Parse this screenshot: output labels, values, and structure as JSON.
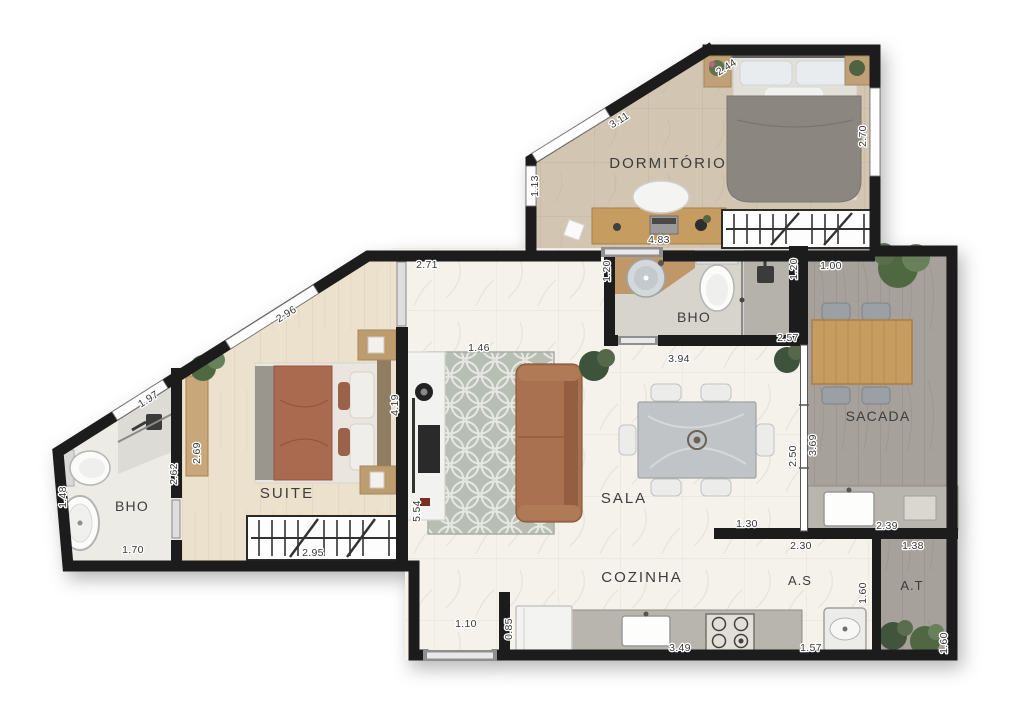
{
  "plan": {
    "rooms": {
      "dormitorio": "DORMITÓRIO",
      "bathroom_top": "BHO",
      "balcony": "SACADA",
      "suite": "SUITE",
      "bathroom_suite": "BHO",
      "living": "SALA",
      "kitchen": "COZINHA",
      "service": "A.S",
      "technical": "A.T"
    },
    "dims": {
      "dorm_diag_upper": "2.44",
      "dorm_diag": "3.11",
      "dorm_left": "1.13",
      "dorm_right": "2.70",
      "dorm_desk": "4.83",
      "hall_width": "2.71",
      "hall_opening": "1.46",
      "bath_top_left": "1.20",
      "bath_top_right": "1.20",
      "bath_top_bottom": "2.57",
      "balcony_top": "1.00",
      "balcony_left": "3.69",
      "balcony_counter": "2.39",
      "living_right": "2.50",
      "living_table": "3.94",
      "living_tv": "5.54",
      "living_kitchen_wall": "1.30",
      "suite_diag": "2.96",
      "suite_bench": "2.69",
      "suite_right": "4.19",
      "suite_wardrobe": "2.95",
      "bath_suite_diag": "1.97",
      "bath_suite_left": "1.48",
      "bath_suite_bottom": "1.70",
      "bath_suite_wall": "2.62",
      "entry_width": "1.10",
      "entry_wall": "0.85",
      "kitchen_counter": "3.49",
      "service_sink": "1.57",
      "service_top": "2.30",
      "service_right": "1.60",
      "technical_top": "1.38",
      "technical_right": "1.60"
    },
    "colors": {
      "wall": "#1a1a1a",
      "floor_marble": "#f5f2ec",
      "floor_wood_suite": "#ebe1cc",
      "floor_tile_dorm": "#d2c5b2",
      "floor_deck": "#a6a19a",
      "rug": "#b9beb4",
      "sofa": "#a9714f",
      "wood_furniture": "#c79c61",
      "counter": "#b8b5ae",
      "threshold": "#8f8f8f"
    }
  }
}
